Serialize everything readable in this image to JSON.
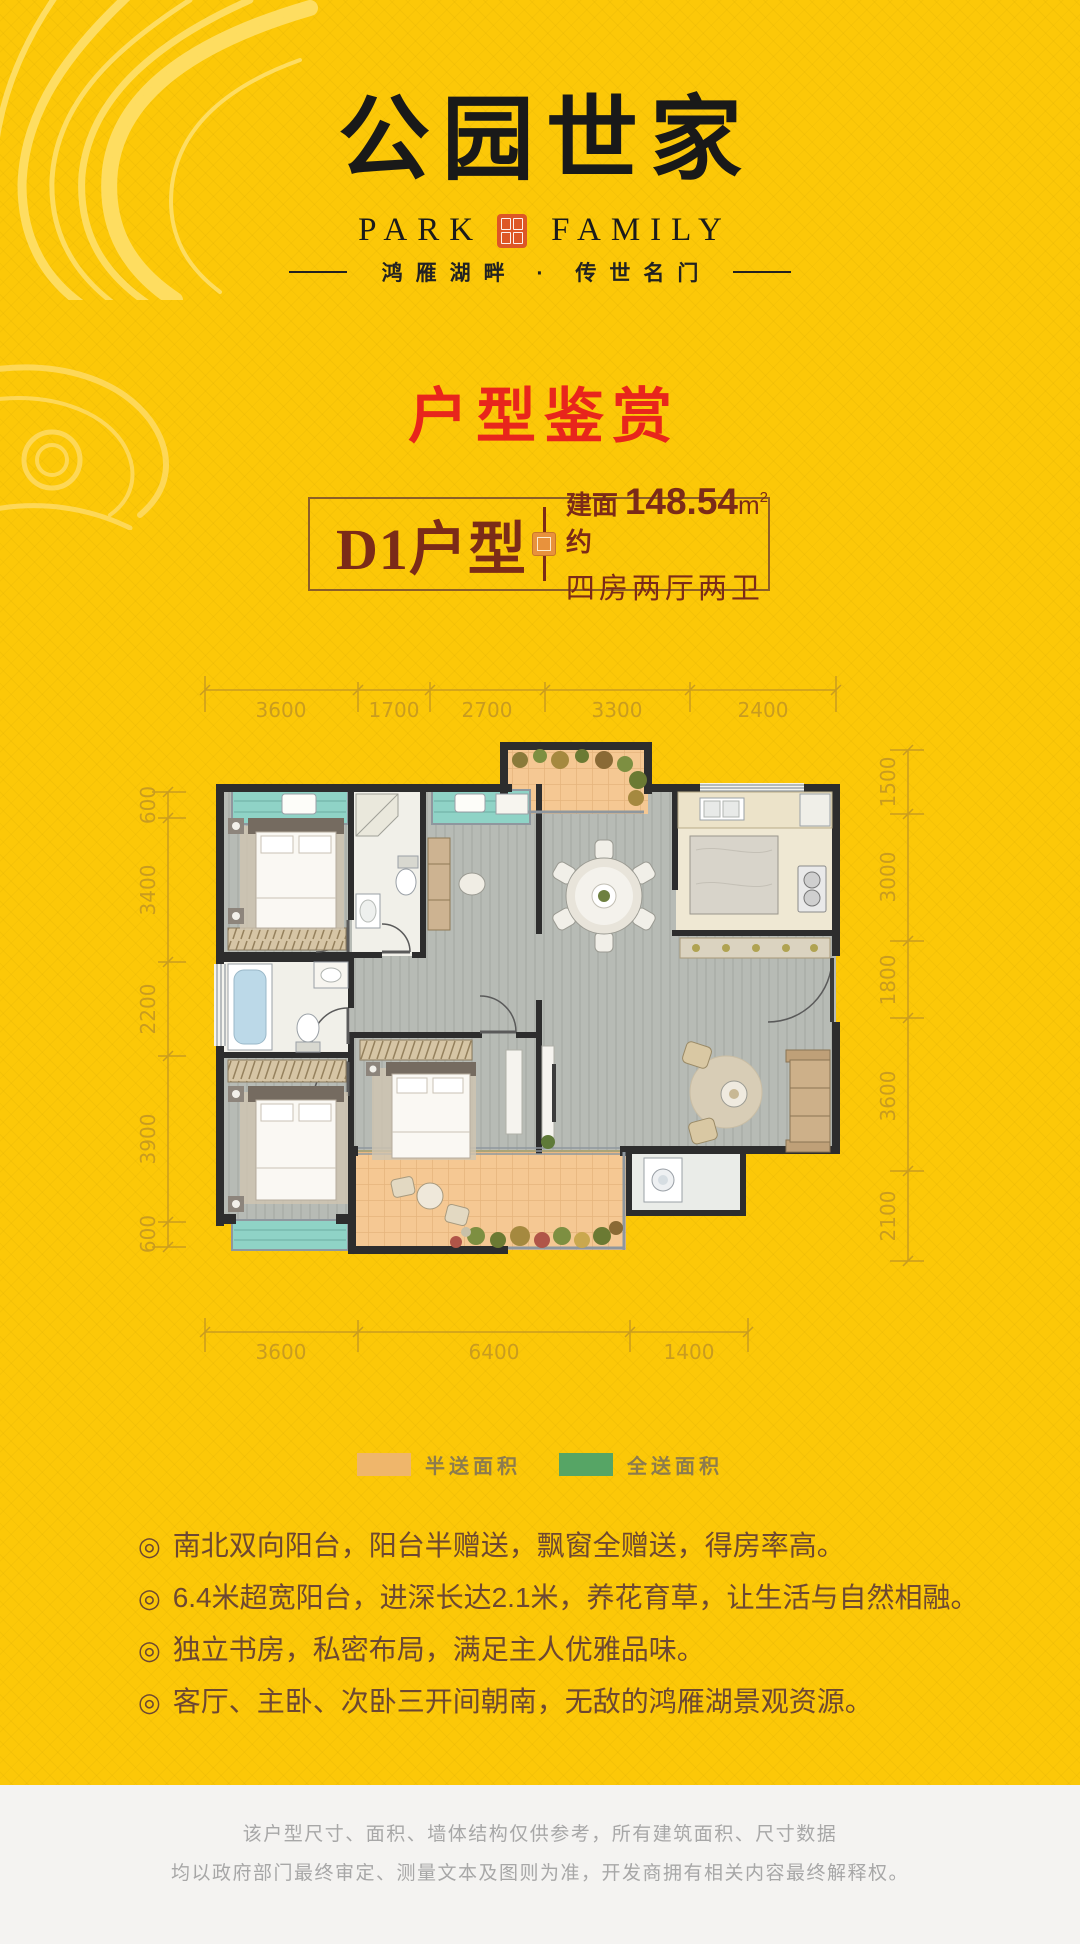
{
  "header": {
    "logo": "公园世家",
    "logo_en_left": "PARK",
    "logo_en_right": "FAMILY",
    "tagline": "鸿雁湖畔 · 传世名门"
  },
  "section_title": "户型鉴赏",
  "unit": {
    "name": "D1户型",
    "area_label": "建面约",
    "area_value": "148.54",
    "area_unit_base": "m",
    "area_unit_sup": "2",
    "rooms": "四房两厅两卫"
  },
  "plan": {
    "dims": {
      "top": [
        "3600",
        "1700",
        "2700",
        "3300",
        "2400"
      ],
      "bottom": [
        "3600",
        "6400",
        "1400"
      ],
      "left": [
        "600",
        "3400",
        "2200",
        "3900",
        "600"
      ],
      "right": [
        "1500",
        "3000",
        "1800",
        "3600",
        "2100"
      ]
    },
    "legend": [
      {
        "label": "半送面积",
        "color": "#efb66b"
      },
      {
        "label": "全送面积",
        "color": "#56a565"
      }
    ]
  },
  "features": {
    "bullet": "◎",
    "items": [
      "南北双向阳台，阳台半赠送，飘窗全赠送，得房率高。",
      "6.4米超宽阳台，进深长达2.1米，养花育草，让生活与自然相融。",
      "独立书房，私密布局，满足主人优雅品味。",
      "客厅、主卧、次卧三开间朝南，无敌的鸿雁湖景观资源。"
    ]
  },
  "footer": {
    "line1": "该户型尺寸、面积、墙体结构仅供参考，所有建筑面积、尺寸数据",
    "line2": "均以政府部门最终审定、测量文本及图则为准，开发商拥有相关内容最终解释权。"
  },
  "colors": {
    "background": "#fcc808",
    "section_title": "#e8251c",
    "unit_text": "#7b2b18",
    "feature_text": "#6d4832",
    "dimension_text": "#c99c1f",
    "legend_half": "#efb66b",
    "legend_full": "#56a565",
    "footer_bg": "#f4f3f1",
    "footer_text": "#a7a7a7",
    "bay_window": "#8fd3c6",
    "balcony_tile": "#f5c893"
  }
}
